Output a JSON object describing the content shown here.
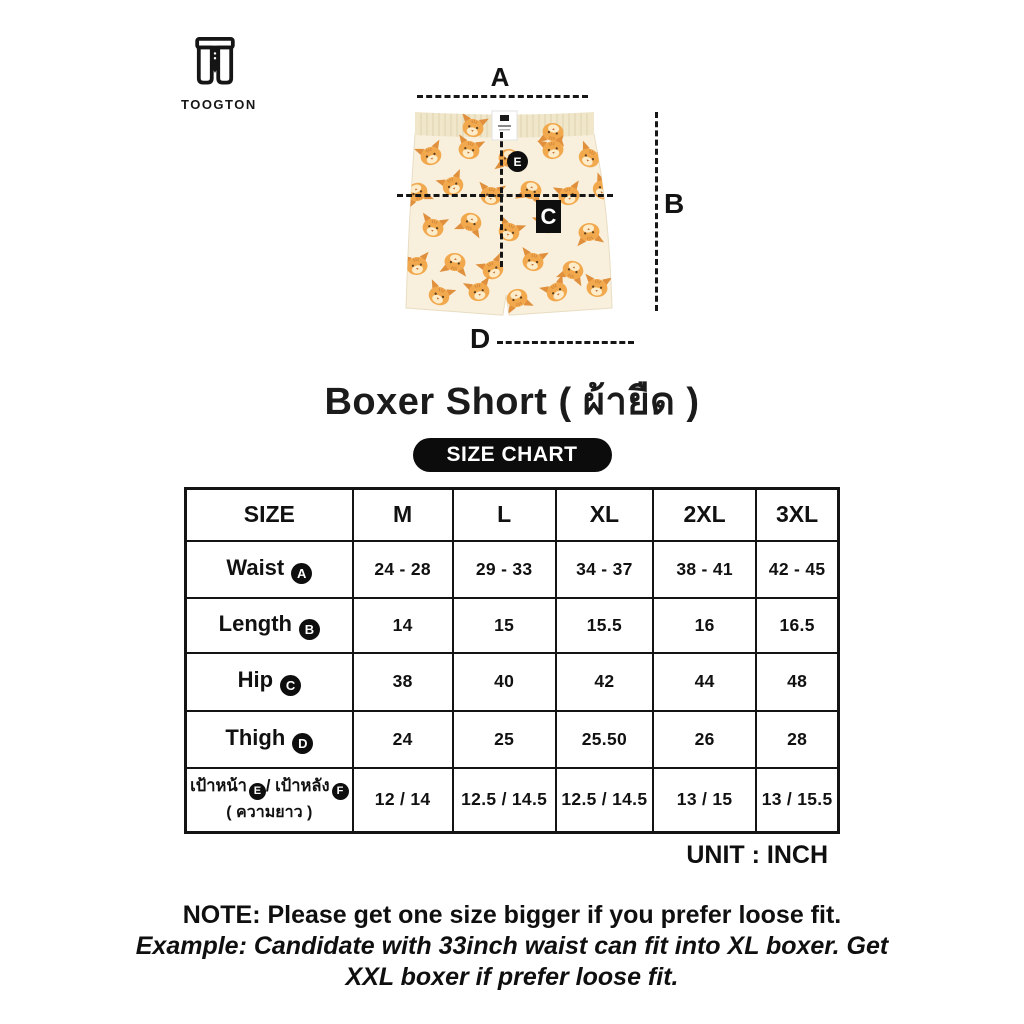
{
  "brand": {
    "name": "TOOGTON"
  },
  "diagram": {
    "markers": {
      "a": "A",
      "b": "B",
      "c": "C",
      "d": "D",
      "e": "E"
    }
  },
  "title": "Boxer Short ( ผ้ายืด )",
  "badge": {
    "label": "SIZE CHART"
  },
  "table": {
    "columns": [
      "SIZE",
      "M",
      "L",
      "XL",
      "2XL",
      "3XL"
    ],
    "rows": [
      {
        "label": "Waist",
        "letter": "A",
        "cells": [
          "24 - 28",
          "29 - 33",
          "34 - 37",
          "38 - 41",
          "42 - 45"
        ]
      },
      {
        "label": "Length",
        "letter": "B",
        "cells": [
          "14",
          "15",
          "15.5",
          "16",
          "16.5"
        ]
      },
      {
        "label": "Hip",
        "letter": "C",
        "cells": [
          "38",
          "40",
          "42",
          "44",
          "48"
        ]
      },
      {
        "label": "Thigh",
        "letter": "D",
        "cells": [
          "24",
          "25",
          "25.50",
          "26",
          "28"
        ]
      },
      {
        "label_front": "เป้าหน้า",
        "letter_front": "E",
        "separator": "/",
        "label_back": "เป้าหลัง",
        "letter_back": "F",
        "label_sub": "( ความยาว )",
        "cells": [
          "12 / 14",
          "12.5 / 14.5",
          "12.5 / 14.5",
          "13 / 15",
          "13 / 15.5"
        ]
      }
    ]
  },
  "unit_label": "UNIT : INCH",
  "note": {
    "line1": "NOTE: Please get one size bigger if you prefer loose fit.",
    "example": "Example: Candidate with 33inch waist can fit into XL boxer. Get XXL boxer if prefer loose fit."
  }
}
